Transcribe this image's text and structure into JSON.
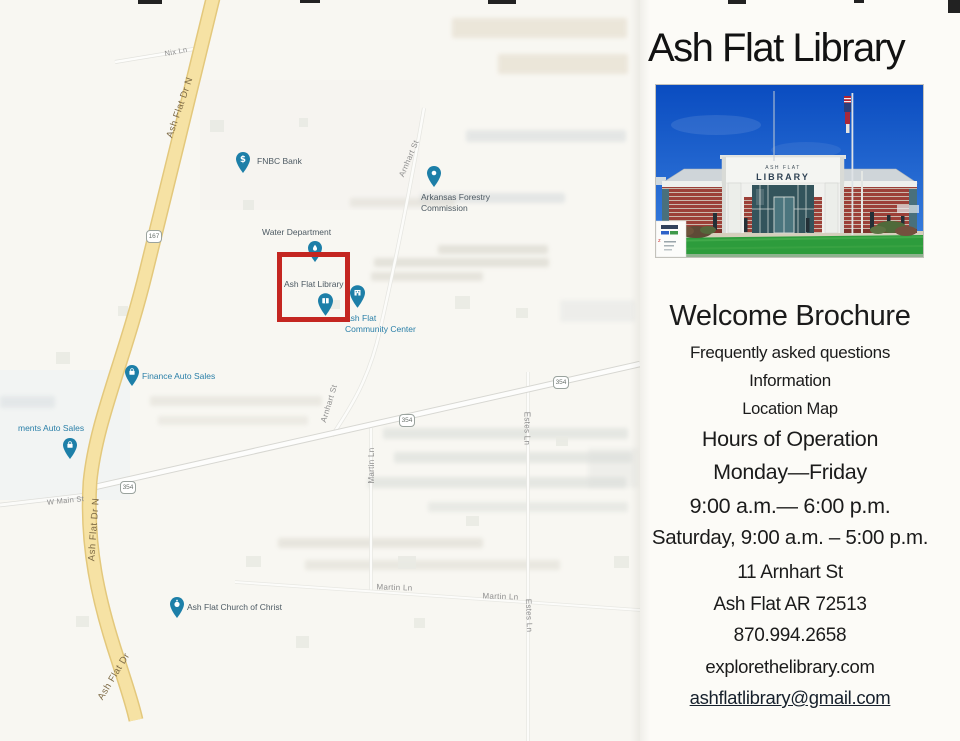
{
  "map": {
    "street_labels": {
      "nix_ln": "Nix Ln",
      "ash_flat_dr_n": "Ash Flat Dr N",
      "ash_flat_dr": "Ash Flat Dr",
      "arnhart_st": "Arnhart St",
      "martin_ln": "Martin Ln",
      "estes_ln": "Estes Ln",
      "w_main_st": "W Main St"
    },
    "route_shields": {
      "us167": "167",
      "ar354": "354"
    },
    "pois": {
      "fnbc_bank": "FNBC Bank",
      "forestry_line1": "Arkansas Forestry",
      "forestry_line2": "Commission",
      "water_department": "Water Department",
      "ash_flat_library": "Ash Flat Library",
      "community_line1": "Ash Flat",
      "community_line2": "Community Center",
      "finance_auto_sales": "Finance Auto Sales",
      "ments_auto_sales": "ments Auto Sales",
      "church": "Ash Flat Church of Christ"
    },
    "highlight_color": "#c42621",
    "pin_color": "#1d7fa8"
  },
  "panel": {
    "title": "Ash Flat Library",
    "photo_sign": {
      "line1": "ASH FLAT",
      "line2": "LIBRARY"
    },
    "lines": {
      "welcome": "Welcome Brochure",
      "faq": "Frequently asked questions",
      "information": "Information",
      "location_map": "Location Map",
      "hours": "Hours of Operation",
      "days": "Monday—Friday",
      "weekday_hours": "9:00 a.m.— 6:00 p.m.",
      "saturday_hours": "Saturday, 9:00 a.m. – 5:00 p.m.",
      "address1": "11 Arnhart St",
      "address2": "Ash Flat AR 72513",
      "phone": "870.994.2658",
      "website": "explorethelibrary.com",
      "email": "ashflatlibrary@gmail.com"
    }
  }
}
